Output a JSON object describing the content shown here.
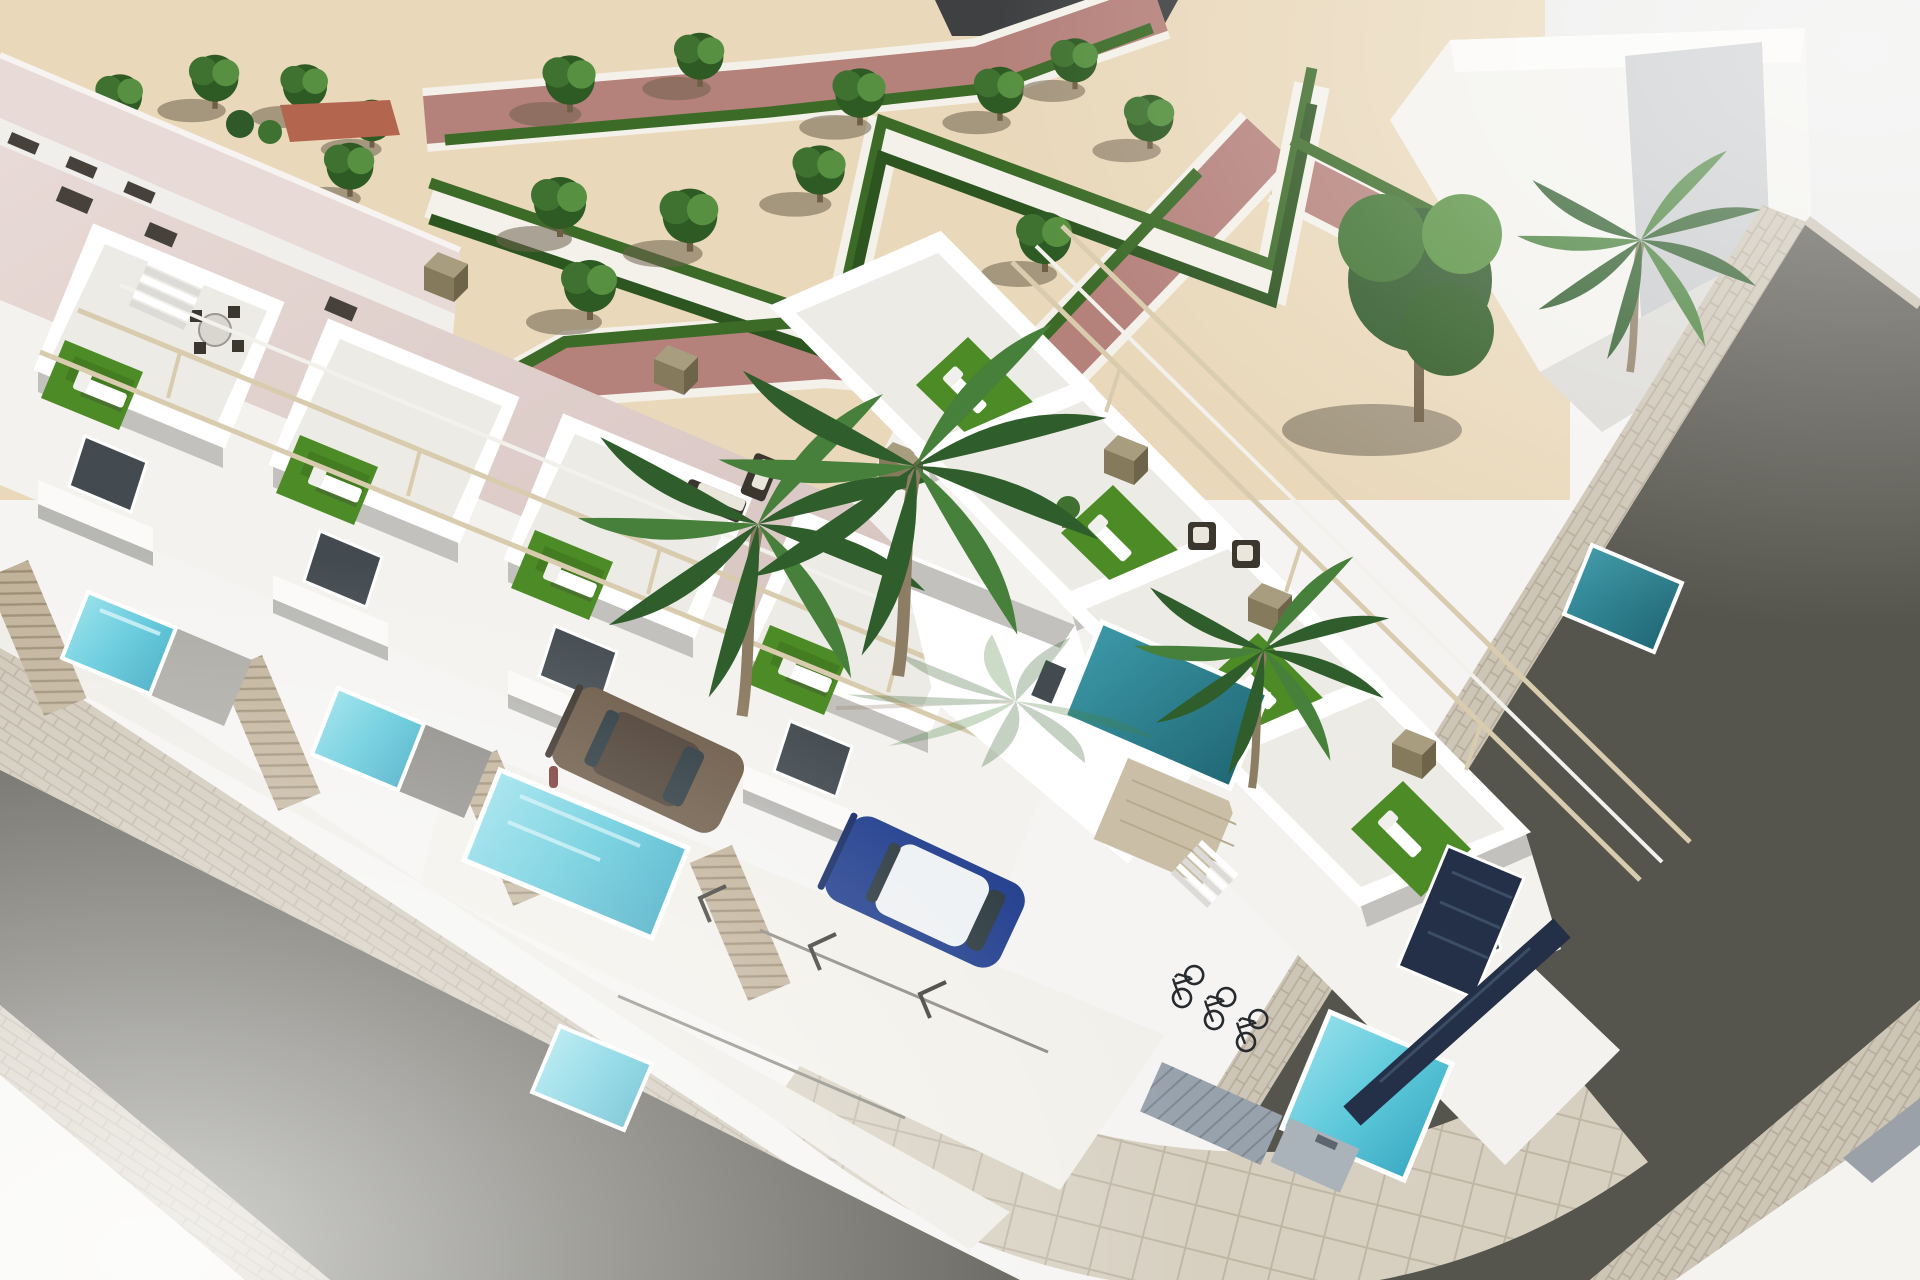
{
  "meta": {
    "type": "3d-architectural-rendering",
    "title": "Aerial 3D rendering of a modern white townhouse development on a street corner, with rooftop terraces, private pools, a landscaped parterre park, parked cars and bicycles",
    "style": "photorealistic CGI, bird's-eye view, bright daylight"
  },
  "palette": {
    "bg": "#f5f4f2",
    "groundWhite": "#f4f3f0",
    "paleTR": "#ecedeb",
    "darkStrip": "#3e4042",
    "sand": "#e9d8ba",
    "sandShadow": "#786950663",
    "pinkPath": "#b5817b",
    "curb": "#f4f1ea",
    "hedge": "#3c6b28",
    "hedgeDark": "#2d5520",
    "crown": "#3f7230",
    "crownDark": "#2e5a23",
    "crownLight": "#569040",
    "trunk": "#6f5f46",
    "bigTree": "#30592a",
    "palmFrond": "#2f5d2b",
    "palmFrondLight": "#47803a",
    "palmTrunk": "#8d7d64",
    "roofPink": "#dcc9c6",
    "roofPinkLight": "#e8dad6",
    "roofHatch": "#46423b",
    "tileRoof": "#b4654e",
    "facadeShadow": "#c8cacc",
    "wallWhite": "#ffffff",
    "wallBright": "#fbfaf8",
    "wallLight": "#f3f2ee",
    "wallShade": "#dcdbd7",
    "wallDark": "#c2c1bd",
    "wallDeep": "#95948f",
    "underShadow": "#46464159",
    "glass": "#434b51",
    "glassLight": "#6e777e",
    "turf": "#4c8b26",
    "turfDark": "#396b1c",
    "poolLight": "#a5e6ef",
    "poolMid": "#5ec9db",
    "poolDeep": "#2f9fba",
    "poolTeal": "#2f8a9a",
    "poolTealDeep": "#1d6270",
    "poolNavy": "#25303d",
    "navySlat": "#3c4d66",
    "rimWhite": "#ffffff",
    "asphalt": "#56554d",
    "paver": "#cdc5b5",
    "paverLine": "#b5ab9a",
    "paverBig": "#d7d0c1",
    "paverBigLine": "#bfb6a5",
    "fence": "#c0b198",
    "fenceLine": "#9a8b72",
    "navyFence": "#243048",
    "pergola": "#d9ccae",
    "pergolaWhite": "#f2f1ec",
    "cubeTop": "#a89d7e",
    "cubeFront": "#857a5c",
    "cubeSide": "#6d644a",
    "wicker": "#3b372e",
    "cushion": "#eae6dc",
    "cabinet": "#98a2ac",
    "cabinetLine": "#7e8892",
    "cabinet2": "#aab3ba",
    "carBronze": "#6d5b48",
    "carBronzeDark": "#4e4136",
    "carBlue": "#223f8e",
    "carBlueDark": "#162c66",
    "carRoofWhite": "#eef1f3",
    "carGlass": "#2c3a40",
    "bike": "#272a2e",
    "person": "#7a3a35",
    "patio": "#a9a8a2",
    "patioDark": "#8b8a85",
    "stairDark": "#c6c5c1",
    "padStripe": "#9aa1a8",
    "markLine": "#3c3c38",
    "divLine": "#8a887f"
  },
  "scene": {
    "park": {
      "label": "landscaped corner park",
      "ground": "sand-coloured gravel",
      "features": [
        "zigzag parterre hedges",
        "white gravel walks",
        "mauve-pink walkways",
        "rows of trees"
      ],
      "tree_count": 21
    },
    "development": {
      "label": "two rows of white modern townhouses meeting at a street corner",
      "left_row_units": 4,
      "right_row_units": 4,
      "features": [
        "rooftop terraces with artificial turf",
        "sun loungers",
        "outdoor dining and wicker lounge sets",
        "beige pergola frames",
        "private plunge pools",
        "slatted privacy fences",
        "balconies with dark glazing",
        "external stairs",
        "beige garage door"
      ]
    },
    "pools": {
      "bright_turquoise": 5,
      "teal": 3,
      "covered_dark": 1
    },
    "streets": {
      "left": "asphalt street with paver sidewalks (lower left)",
      "right": "asphalt street with paver sidewalks (right)",
      "corner": "rounded corner with large square paving slabs"
    },
    "vehicles": {
      "cars": [
        {
          "color_name": "bronze",
          "position": "parking bay by pool"
        },
        {
          "color_name": "blue with white roof",
          "position": "parking court"
        }
      ],
      "bicycles": 3
    },
    "other": [
      "palm trees by the entrance",
      "utility meter cabinets at the corner",
      "large neighbouring building with pale pink roof (top left)",
      "blank white gable building (top right)",
      "tiny person on a balcony"
    ]
  }
}
